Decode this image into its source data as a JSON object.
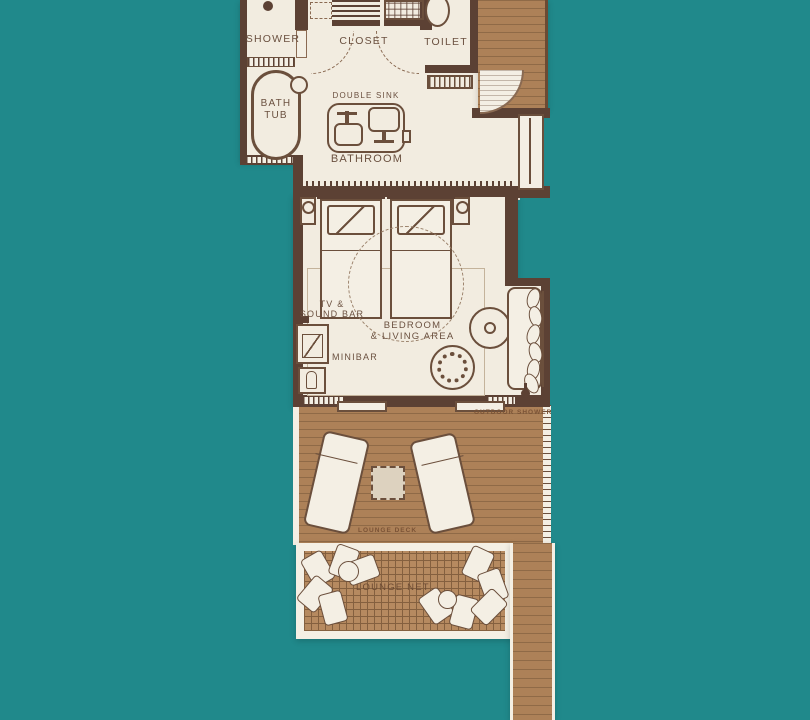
{
  "colors": {
    "water": "#20898b",
    "wall": "#5c4134",
    "interior": "#f2ece0",
    "outline": "#6b4f3c",
    "outline_light": "#8a6a52",
    "deck": "#ad8158",
    "deck_line": "#8f6a47",
    "deck_border": "#6b4a33",
    "net": "#b68a60",
    "net_line": "#84603f",
    "white_trim": "#f4efe4",
    "label": "#6b5140",
    "label_small": "#7b5336"
  },
  "labels": {
    "shower": "SHOWER",
    "closet": "CLOSET",
    "toilet": "TOILET",
    "bath_l1": "BATH",
    "bath_l2": "TUB",
    "double_sink": "DOUBLE SINK",
    "bathroom": "BATHROOM",
    "tv_l1": "TV &",
    "tv_l2": "SOUND BAR",
    "minibar": "MINIBAR",
    "bedroom_l1": "BEDROOM",
    "bedroom_l2": "& LIVING AREA",
    "outdoor_shower": "OUTDOOR SHOWER",
    "lounge_deck": "LOUNGE DECK",
    "lounge_net": "LOUNGE NET"
  }
}
